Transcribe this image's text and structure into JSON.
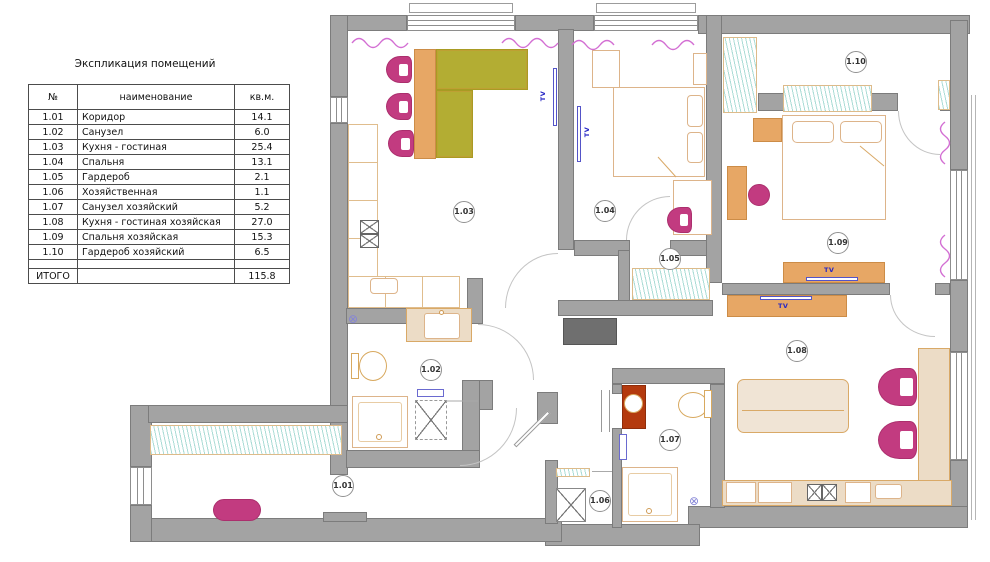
{
  "legend": {
    "title": "Экспликация помещений",
    "columns": [
      "№",
      "наименование",
      "кв.м."
    ],
    "rows": [
      {
        "num": "1.01",
        "name": "Коридор",
        "area": "14.1"
      },
      {
        "num": "1.02",
        "name": "Санузел",
        "area": "6.0"
      },
      {
        "num": "1.03",
        "name": "Кухня - гостиная",
        "area": "25.4"
      },
      {
        "num": "1.04",
        "name": "Спальня",
        "area": "13.1"
      },
      {
        "num": "1.05",
        "name": "Гардероб",
        "area": "2.1"
      },
      {
        "num": "1.06",
        "name": "Хозяйственная",
        "area": "1.1"
      },
      {
        "num": "1.07",
        "name": "Санузел хозяйский",
        "area": "5.2"
      },
      {
        "num": "1.08",
        "name": "Кухня - гостиная хозяйская",
        "area": "27.0"
      },
      {
        "num": "1.09",
        "name": "Спальня хозяйская",
        "area": "15.3"
      },
      {
        "num": "1.10",
        "name": "Гардероб хозяйский",
        "area": "6.5"
      }
    ],
    "total_label": "ИТОГО",
    "total_area": "115.8"
  },
  "plan": {
    "tv_label": "TV",
    "drain_symbol": "⊗",
    "rooms": [
      {
        "label": "1.01"
      },
      {
        "label": "1.02"
      },
      {
        "label": "1.03"
      },
      {
        "label": "1.04"
      },
      {
        "label": "1.05"
      },
      {
        "label": "1.06"
      },
      {
        "label": "1.07"
      },
      {
        "label": "1.08"
      },
      {
        "label": "1.09"
      },
      {
        "label": "1.10"
      }
    ]
  },
  "colors": {
    "wall_fill": "#a3a3a3",
    "wall_line": "#7c7c7c",
    "furniture_magenta": "#c23b80",
    "table_olive": "#b3ad33",
    "cabinet_orange": "#e7a765",
    "counter_beige": "#ecdcc6",
    "outline_tan": "#d9a967",
    "vanity_red": "#b43a0e",
    "wardrobe_hatch_teal": "#abdcd6",
    "curtain_pink": "#d36fd3",
    "tv_blue": "#2626c4",
    "console_gray": "#6f6f6f"
  }
}
